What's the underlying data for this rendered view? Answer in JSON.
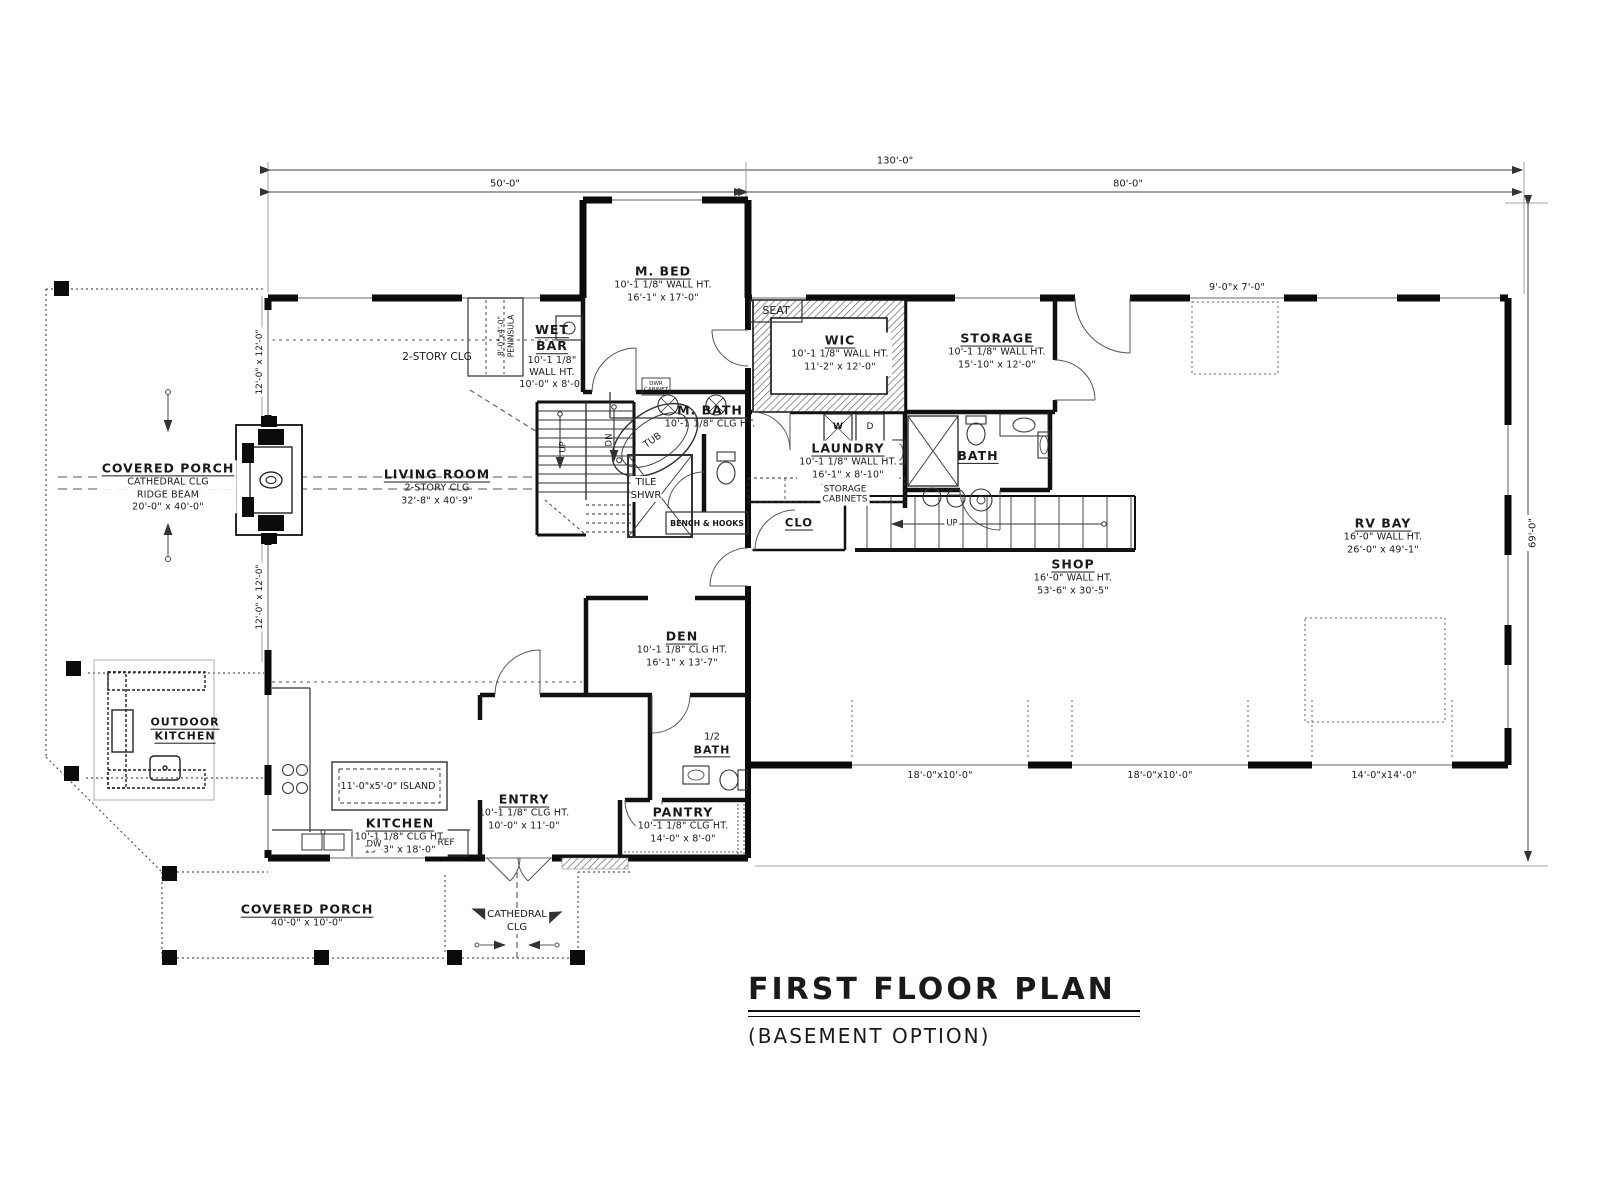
{
  "title": {
    "main": "FIRST FLOOR PLAN",
    "subtitle": "(BASEMENT OPTION)"
  },
  "dimensions": {
    "overall_width": "130'-0\"",
    "width_left": "50'-0\"",
    "width_right": "80'-0\"",
    "overall_depth": "69'-0\"",
    "porch_bay_upper": "12'-0\" x 12'-0\"",
    "porch_bay_lower": "12'-0\" x 12'-0\"",
    "rv_overhead_door": "9'-0\"x 7'-0\"",
    "garage_door_left": "18'-0\"x10'-0\"",
    "garage_door_mid": "18'-0\"x10'-0\"",
    "garage_door_right": "14'-0\"x14'-0\""
  },
  "rooms": {
    "m_bed": {
      "name": "M. BED",
      "wall_ht": "10'-1 1/8\" WALL HT.",
      "size": "16'-1\" x 17'-0\""
    },
    "wet_bar": {
      "name1": "WET",
      "name2": "BAR",
      "ht1": "10'-1 1/8\"",
      "ht2": "WALL HT.",
      "size": "10'-0\" x 8'-0\""
    },
    "m_bath": {
      "name": "M. BATH",
      "clg": "10'-1 1/8\" CLG HT."
    },
    "wic": {
      "name": "WIC",
      "wall_ht": "10'-1 1/8\" WALL HT.",
      "size": "11'-2\" x 12'-0\""
    },
    "storage": {
      "name": "STORAGE",
      "wall_ht": "10'-1 1/8\" WALL HT.",
      "size": "15'-10\" x 12'-0\""
    },
    "laundry": {
      "name": "LAUNDRY",
      "wall_ht": "10'-1 1/8\" WALL HT.",
      "size": "16'-1\" x 8'-10\""
    },
    "bath": {
      "name": "BATH"
    },
    "half_bath": {
      "line1": "1/2",
      "line2": "BATH"
    },
    "den": {
      "name": "DEN",
      "clg": "10'-1 1/8\" CLG HT.",
      "size": "16'-1\" x 13'-7\""
    },
    "living_room": {
      "name": "LIVING ROOM",
      "clg": "2-STORY CLG",
      "size": "32'-8\" x 40'-9\""
    },
    "kitchen": {
      "name": "KITCHEN",
      "clg": "10'-1 1/8\" CLG HT.",
      "size": "19'-3\" x 18'-0\""
    },
    "entry": {
      "name": "ENTRY",
      "clg": "10'-1 1/8\" CLG HT.",
      "size": "10'-0\" x 11'-0\""
    },
    "pantry": {
      "name": "PANTRY",
      "clg": "10'-1 1/8\" CLG HT.",
      "size": "14'-0\" x 8'-0\""
    },
    "shop": {
      "name": "SHOP",
      "wall_ht": "16'-0\" WALL HT.",
      "size": "53'-6\" x 30'-5\""
    },
    "rv_bay": {
      "name": "RV BAY",
      "wall_ht": "16'-0\" WALL HT.",
      "size": "26'-0\" x 49'-1\""
    },
    "outdoor_kitchen": {
      "line1": "OUTDOOR",
      "line2": "KITCHEN"
    },
    "covered_porch_left": {
      "name": "COVERED PORCH",
      "clg": "CATHEDRAL CLG",
      "beam": "RIDGE BEAM",
      "size": "20'-0\" x 40'-0\""
    },
    "covered_porch_bottom": {
      "name": "COVERED PORCH",
      "size": "40'-0\" x 10'-0\""
    },
    "clo": {
      "name": "CLO"
    }
  },
  "annotations": {
    "two_story_clg": "2-STORY CLG",
    "peninsula_size": "8'-0\"x4'-0\"",
    "peninsula": "PENINSULA",
    "seat": "SEAT",
    "island": "11'-0\"x5'-0\" ISLAND",
    "cathedral1": "CATHEDRAL",
    "cathedral2": "CLG",
    "storage_cab1": "STORAGE",
    "storage_cab2": "CABINETS",
    "bench_hooks": "BENCH & HOOKS",
    "tile1": "TILE",
    "tile2": "SHWR",
    "tub": "TUB",
    "dwr1": "DWR",
    "dwr2": "CABINET",
    "washer": "W",
    "dryer": "D",
    "dishwasher": "DW",
    "fridge": "REF",
    "up_main": "UP",
    "dn_main": "DN",
    "up_shop": "UP"
  }
}
